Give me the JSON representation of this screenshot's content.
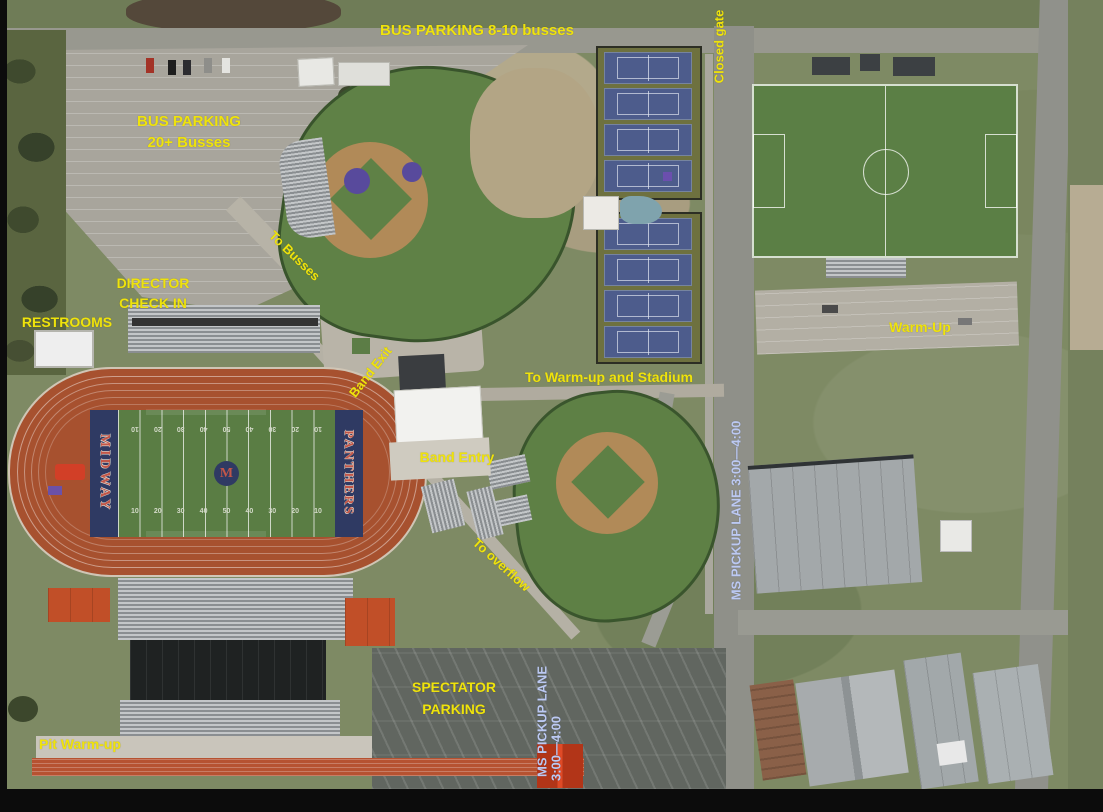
{
  "map": {
    "labels": {
      "bus_parking_top": "BUS PARKING 8-10 busses",
      "closed_gate": "Closed gate",
      "bus_parking_lot": {
        "line1": "BUS PARKING",
        "line2": "20+ Busses"
      },
      "director_check_in": {
        "line1": "DIRECTOR",
        "line2": "CHECK IN"
      },
      "restrooms": "RESTROOMS",
      "to_busses": "To Busses",
      "band_exit": "Band Exit",
      "to_warm_up_and_stadium": "To Warm-up and Stadium",
      "band_entry": "Band Entry",
      "warm_up": "Warm-Up",
      "ms_pickup_lane_right": "MS PICKUP LANE 3:00—4:00",
      "to_overflow": "To overflow",
      "spectator_parking": {
        "line1": "SPECTATOR",
        "line2": "PARKING"
      },
      "ms_pickup_lane_bottom": {
        "line1": "MS PICKUP LANE",
        "line2": "3:00—4:00"
      },
      "pit_warm_up": "Pit Warm-up"
    },
    "field": {
      "home_endzone": "MIDWAY",
      "visitor_endzone": "PANTHERS",
      "logo_letter": "M",
      "yard_numbers": [
        "10",
        "20",
        "30",
        "40",
        "50",
        "40",
        "30",
        "20",
        "10"
      ]
    },
    "colors": {
      "annotation_yellow": "#efe30c",
      "pickup_lane_blue": "#bcc9f2",
      "track_orange": "#a7512f",
      "endzone_navy": "#2f3a63",
      "turf_green": "#5a7d44",
      "tennis_court_blue": "#4d5c8c"
    }
  }
}
